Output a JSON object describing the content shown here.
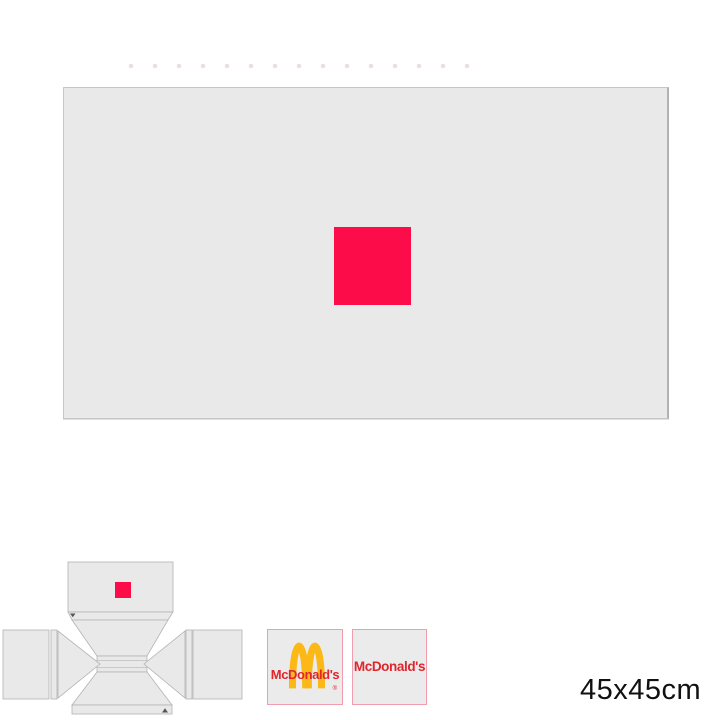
{
  "size_label": "45x45cm",
  "colors": {
    "page_bg": "#ffffff",
    "panel_gray": "#e9e9e9",
    "panel_border": "#c6c6c6",
    "accent_red": "#FC0D49",
    "dieline_fill": "#e9e9e9",
    "dieline_stroke": "#b2b2b2",
    "tile_bg": "#ebebeb",
    "tile_border": "#F29CAD",
    "brand_gold": "#FBB817",
    "brand_red": "#E0252C",
    "mark_dark": "#555555"
  },
  "preview": {
    "marker_name": "red-artwork-square"
  },
  "dieline": {
    "marker_name": "red-artwork-square",
    "fold_mark_top": "fold-arrow",
    "fold_mark_bottom": "fold-arrow"
  },
  "textures": {
    "arches_tile": {
      "icon": "golden-arches-logo",
      "brand_text": "McDonald's",
      "registered_mark": "®"
    },
    "wordmark_tile": {
      "brand_text": "McDonald's"
    }
  }
}
